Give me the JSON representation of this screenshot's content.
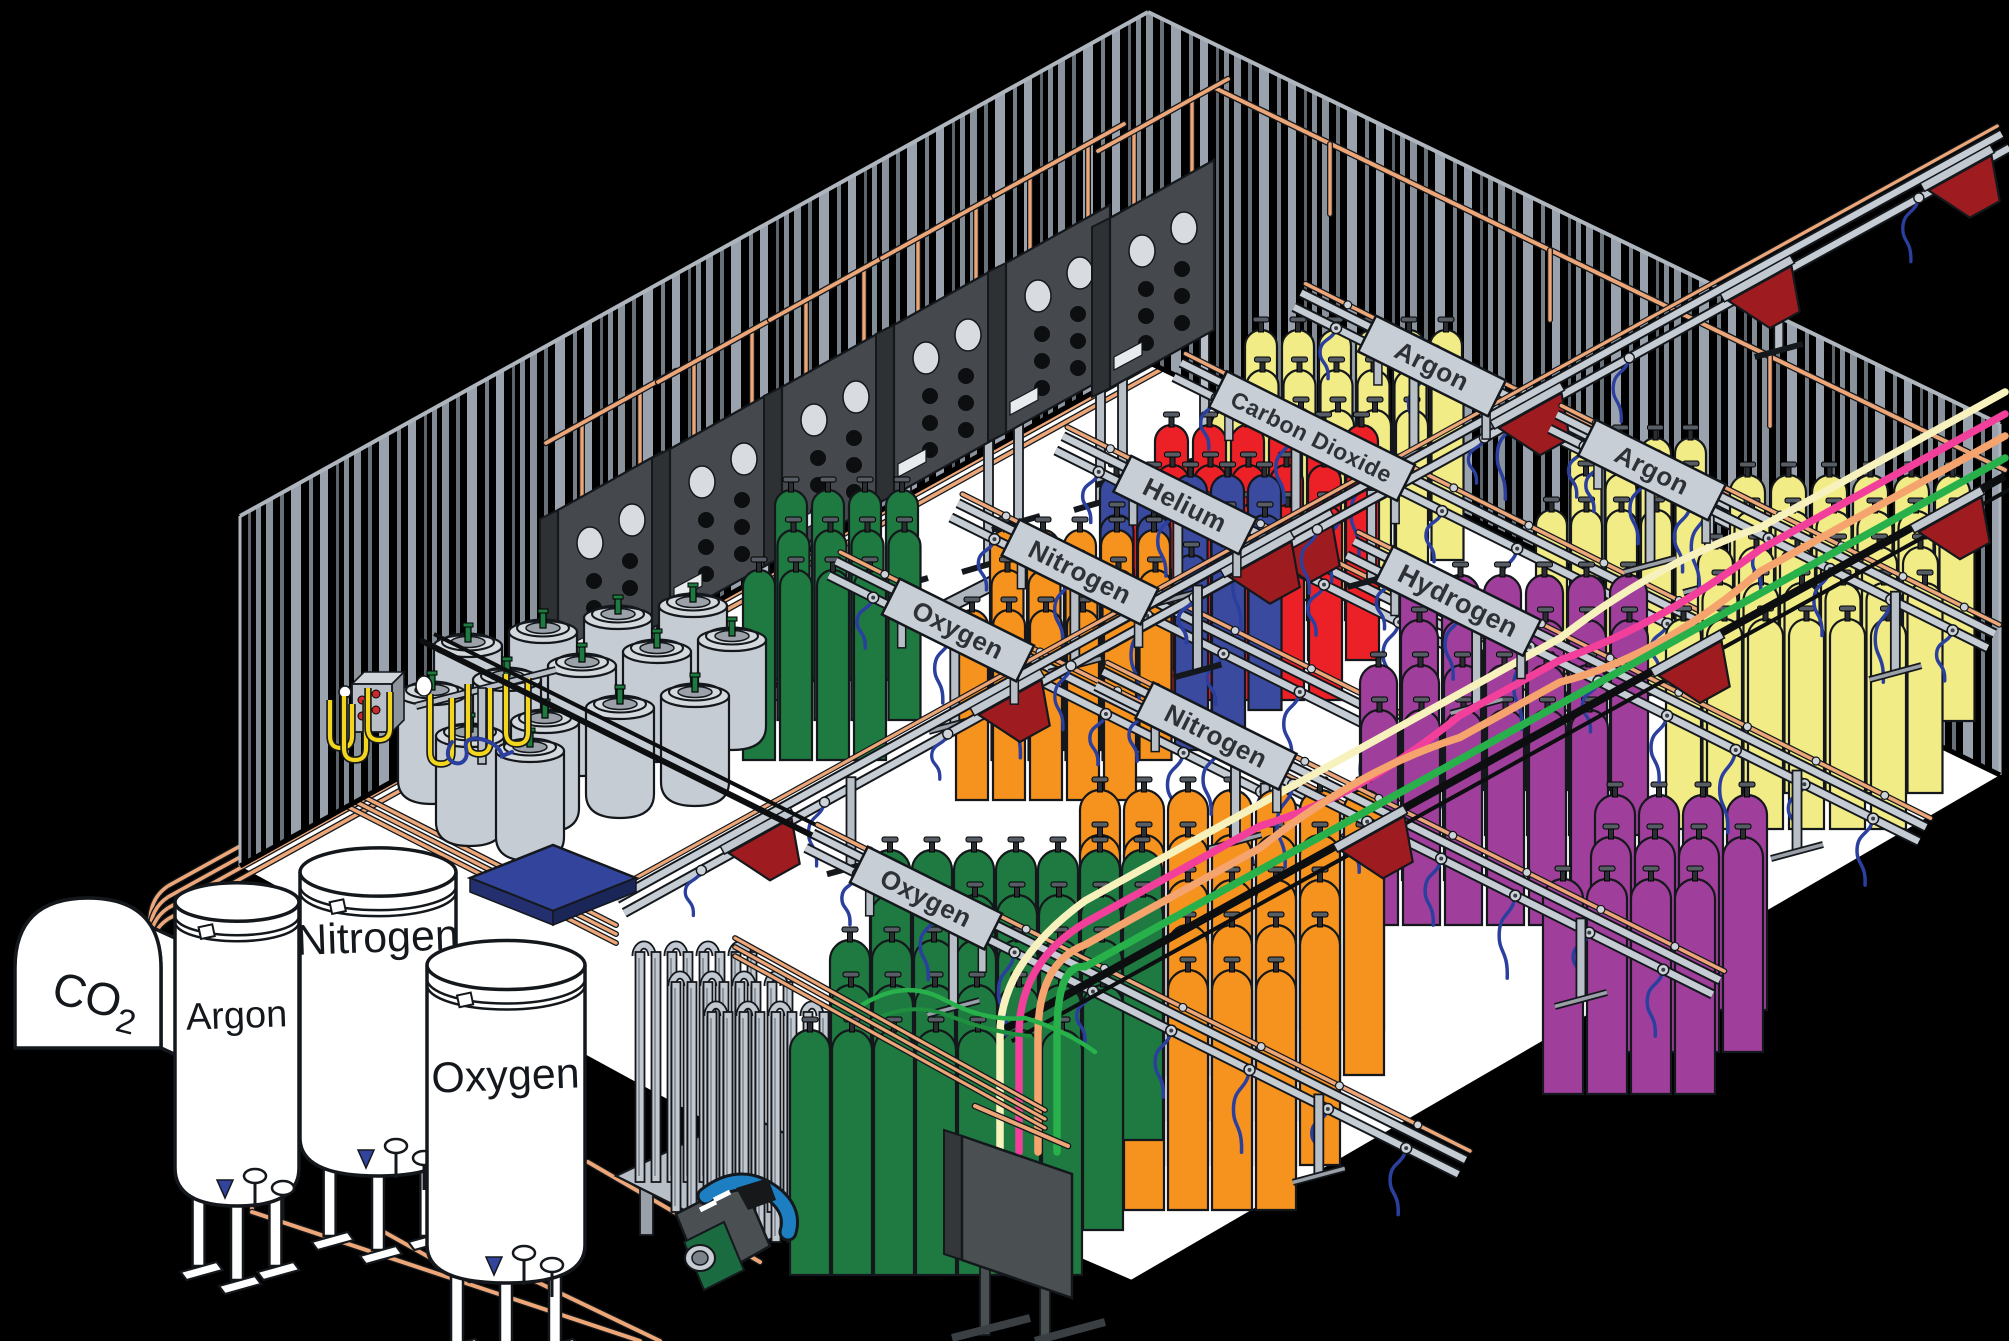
{
  "title": "Gas cylinder filling plant - isometric cutaway illustration",
  "stations": [
    {
      "label": "Oxygen",
      "x": 958,
      "y": 630,
      "len": 150,
      "fs": 26,
      "back": 140,
      "fwd": 480,
      "hoses": 7
    },
    {
      "label": "Nitrogen",
      "x": 1080,
      "y": 572,
      "len": 155,
      "fs": 26,
      "back": 140,
      "fwd": 470,
      "hoses": 7
    },
    {
      "label": "Helium",
      "x": 1185,
      "y": 505,
      "len": 140,
      "fs": 26,
      "back": 140,
      "fwd": 460,
      "hoses": 7
    },
    {
      "label": "Carbon Dioxide",
      "x": 1312,
      "y": 436,
      "len": 210,
      "fs": 23,
      "back": 150,
      "fwd": 450,
      "hoses": 7
    },
    {
      "label": "Argon",
      "x": 1432,
      "y": 366,
      "len": 145,
      "fs": 26,
      "back": 150,
      "fwd": 440,
      "hoses": 6
    },
    {
      "label": "Hydrogen",
      "x": 1458,
      "y": 601,
      "len": 165,
      "fs": 27,
      "back": 120,
      "fwd": 520,
      "hoses": 8
    },
    {
      "label": "Argon",
      "x": 1652,
      "y": 470,
      "len": 145,
      "fs": 26,
      "back": 110,
      "fwd": 380,
      "hoses": 7
    },
    {
      "label": "Nitrogen",
      "x": 1216,
      "y": 736,
      "len": 160,
      "fs": 26,
      "back": 130,
      "fwd": 560,
      "hoses": 8
    },
    {
      "label": "Oxygen",
      "x": 926,
      "y": 898,
      "len": 150,
      "fs": 26,
      "back": 130,
      "fwd": 600,
      "hoses": 8
    }
  ],
  "tanks": [
    {
      "label": "CO2"
    },
    {
      "label": "Argon",
      "cx": 237,
      "top": 902,
      "rx": 62,
      "bottom": 1168,
      "labelY": 1028,
      "fs": 38
    },
    {
      "label": "Nitrogen",
      "cx": 378,
      "top": 872,
      "rx": 78,
      "bottom": 1138,
      "labelY": 952,
      "fs": 43
    },
    {
      "label": "Oxygen",
      "cx": 506,
      "top": 965,
      "rx": 79,
      "bottom": 1245,
      "labelY": 1090,
      "fs": 43
    }
  ],
  "clusters": [
    {
      "name": "carbon-dioxide-cylinders",
      "z": "a",
      "color": "#f1ec86",
      "x": 1245,
      "y": 330,
      "cols": 6,
      "dx": 37,
      "rows": 3,
      "rx": -17,
      "ry": 40,
      "w": 32,
      "h": 190
    },
    {
      "name": "helium-cylinders",
      "z": "a",
      "color": "#ec2127",
      "x": 1155,
      "y": 425,
      "cols": 6,
      "dx": 38,
      "rows": 3,
      "rx": -18,
      "ry": 40,
      "w": 33,
      "h": 195
    },
    {
      "name": "blue-nitrogen-cylinders",
      "z": "a",
      "color": "#3a4a9f",
      "x": 1100,
      "y": 475,
      "cols": 5,
      "dx": 37,
      "rows": 3,
      "rx": -18,
      "ry": 40,
      "w": 33,
      "h": 195
    },
    {
      "name": "orange-cylinders-back",
      "z": "a",
      "color": "#f6921e",
      "x": 990,
      "y": 530,
      "cols": 5,
      "dx": 37,
      "rows": 3,
      "rx": -17,
      "ry": 40,
      "w": 32,
      "h": 190
    },
    {
      "name": "green-cylinders-back",
      "z": "a",
      "color": "#1e7a40",
      "x": 775,
      "y": 490,
      "cols": 4,
      "dx": 37,
      "rows": 3,
      "rx": -16,
      "ry": 40,
      "w": 32,
      "h": 190
    },
    {
      "name": "argon-cylinders-top",
      "z": "a",
      "color": "#f1ec86",
      "x": 1570,
      "y": 438,
      "cols": 4,
      "dx": 35,
      "rows": 3,
      "rx": -17,
      "ry": 36,
      "w": 31,
      "h": 185
    },
    {
      "name": "hydrogen-cylinders",
      "z": "b",
      "color": "#a03f9b",
      "x": 1400,
      "y": 575,
      "cols": 6,
      "dx": 42,
      "rows": 4,
      "rx": -20,
      "ry": 45,
      "w": 37,
      "h": 215
    },
    {
      "name": "argon-cylinders-right",
      "z": "b",
      "color": "#f1ec86",
      "x": 1730,
      "y": 475,
      "cols": 6,
      "dx": 41,
      "rows": 5,
      "rx": -16,
      "ry": 36,
      "w": 35,
      "h": 210
    },
    {
      "name": "orange-cylinders-front",
      "z": "c",
      "color": "#f6921e",
      "x": 1080,
      "y": 790,
      "cols": 7,
      "dx": 44,
      "rows": 5,
      "rx": -22,
      "ry": 45,
      "w": 40,
      "h": 240
    },
    {
      "name": "hydrogen-cylinders-front",
      "z": "c",
      "color": "#a03f9b",
      "x": 1595,
      "y": 795,
      "cols": 4,
      "dx": 44,
      "rows": 3,
      "rx": -26,
      "ry": 42,
      "w": 40,
      "h": 215
    },
    {
      "name": "green-cylinders-front",
      "z": "c",
      "color": "#1e7a40",
      "x": 870,
      "y": 850,
      "cols": 7,
      "dx": 42,
      "rows": 5,
      "rx": -20,
      "ry": 45,
      "w": 40,
      "h": 245
    }
  ],
  "ne_rails": [
    {
      "x1": 620,
      "y1": 905,
      "x2": 1390,
      "y2": 479,
      "bins": [
        760,
        1010,
        1260
      ],
      "dark": false
    },
    {
      "x1": 1100,
      "y1": 640,
      "x2": 2005,
      "y2": 140,
      "bins": [
        1300,
        1530,
        1760,
        1960
      ],
      "dark": false
    },
    {
      "x1": 1005,
      "y1": 1029,
      "x2": 2005,
      "y2": 476,
      "bins": [
        1373,
        1690,
        1950
      ],
      "dark": true
    }
  ],
  "dewars": [
    [
      693,
      600
    ],
    [
      618,
      612
    ],
    [
      543,
      626
    ],
    [
      732,
      634
    ],
    [
      468,
      640
    ],
    [
      657,
      646
    ],
    [
      582,
      660
    ],
    [
      507,
      674
    ],
    [
      432,
      688
    ],
    [
      695,
      690
    ],
    [
      620,
      702
    ],
    [
      545,
      716
    ],
    [
      470,
      730
    ],
    [
      530,
      745
    ]
  ],
  "tubes": {
    "colors": [
      "#f7f2bd",
      "#f23f9b",
      "#f6a46e",
      "#28b04a"
    ],
    "offsets": [
      84,
      62,
      40,
      18
    ]
  },
  "colors": {
    "background": "#000000",
    "floor": "#ffffff",
    "wall_stripe": "#9aa3ad",
    "copper": "#eda678",
    "rail_gray": "#c6ccd4",
    "sign_bg": "#c8ced6",
    "sign_text": "#2e3135",
    "hose_blue": "#2b3f9e",
    "hose_yellow": "#f2d51c",
    "manifold_red": "#9e1c20",
    "panel_dark": "#45494d",
    "cyl_green": "#1e7a40",
    "cyl_orange": "#f6921e",
    "cyl_blue": "#3a4a9f",
    "cyl_red": "#ec2127",
    "cyl_yellow": "#f1ec86",
    "cyl_purple": "#a03f9b",
    "dewar_gray": "#c6ccd3",
    "pallet_blue": "#32449b",
    "pump_blue": "#1d7fc1",
    "pump_green": "#1b6b40"
  }
}
